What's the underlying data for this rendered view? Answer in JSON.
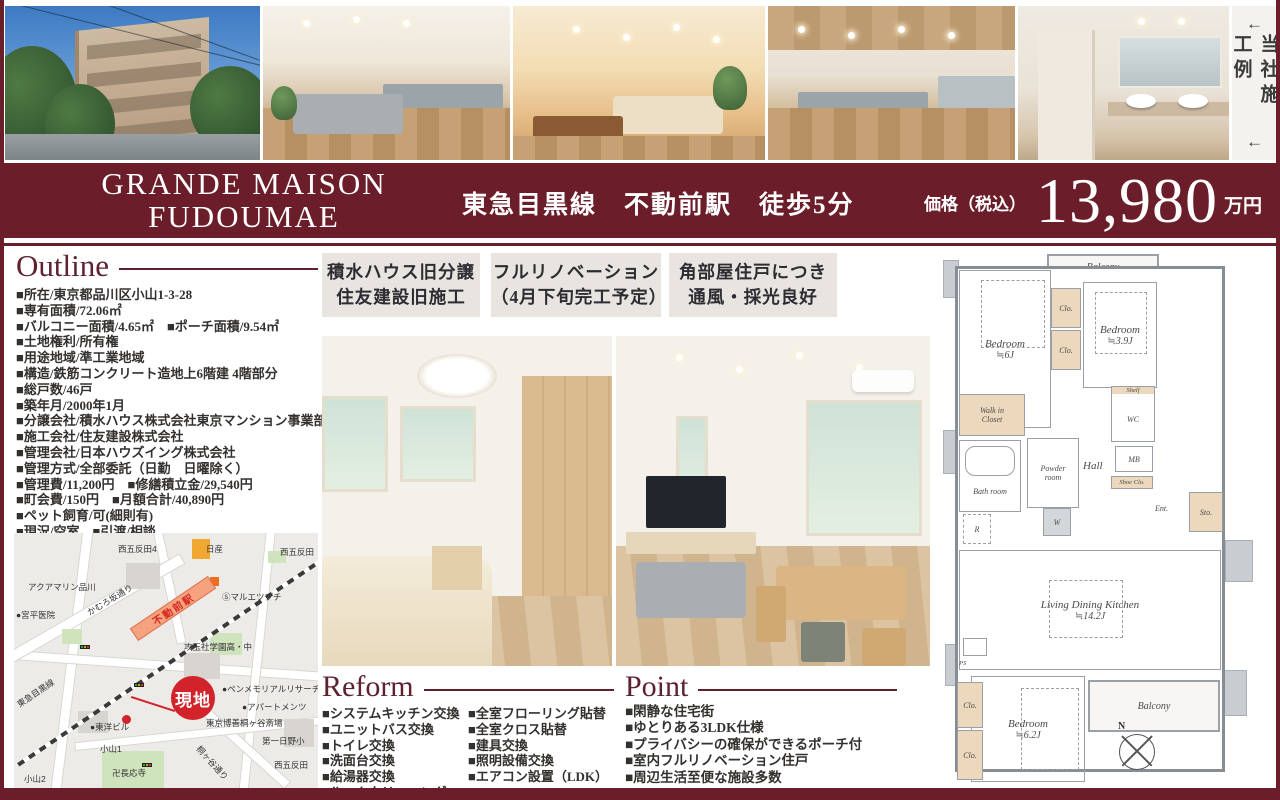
{
  "banner": {
    "arrow_top": "←",
    "text": "当社施工例",
    "arrow_bottom": "←"
  },
  "title_band": {
    "name_line1": "GRANDE MAISON",
    "name_line2": "FUDOUMAE",
    "access": "東急目黒線　不動前駅　徒歩5分",
    "price_label": "価格（税込）",
    "price_value": "13,980",
    "price_unit": "万円",
    "band_color": "#6b1e2a"
  },
  "outline": {
    "title": "Outline",
    "items": [
      "■所在/東京都品川区小山1-3-28",
      "■専有面積/72.06㎡",
      "■バルコニー面積/4.65㎡　■ポーチ面積/9.54㎡",
      "■土地権利/所有権",
      "■用途地域/準工業地域",
      "■構造/鉄筋コンクリート造地上6階建 4階部分",
      "■総戸数/46戸",
      "■築年月/2000年1月",
      "■分譲会社/積水ハウス株式会社東京マンション事業部",
      "■施工会社/住友建設株式会社",
      "■管理会社/日本ハウズイング株式会社",
      "■管理方式/全部委託（日勤　日曜除く）",
      "■管理費/11,200円　■修繕積立金/29,540円",
      "■町会費/150円　■月額合計/40,890円",
      "■ペット飼育/可(細則有)",
      "■現況/空室　■引渡/相談",
      "■備考/長期修繕計画書有"
    ]
  },
  "highlights": [
    {
      "line1": "積水ハウス旧分譲",
      "line2": "住友建設旧施工"
    },
    {
      "line1": "フルリノベーション",
      "line2": "（4月下旬完工予定）"
    },
    {
      "line1": "角部屋住戸につき",
      "line2": "通風・採光良好"
    }
  ],
  "reform": {
    "title": "Reform",
    "col1": [
      "■システムキッチン交換",
      "■ユニットバス交換",
      "■トイレ交換",
      "■洗面台交換",
      "■給湯器交換",
      "■ルームクリーニング"
    ],
    "col2": [
      "■全室フローリング貼替",
      "■全室クロス貼替",
      "■建具交換",
      "■照明設備交換",
      "■エアコン設置（LDK）"
    ]
  },
  "point": {
    "title": "Point",
    "items": [
      "■閑静な住宅街",
      "■ゆとりある3LDK仕様",
      "■プライバシーの確保ができるポーチ付",
      "■室内フルリノベーション住戸",
      "■周辺生活至便な施設多数"
    ]
  },
  "map": {
    "site_marker": "現地",
    "station": "不動前駅",
    "labels": [
      "西五反田4",
      "日産",
      "西五反田",
      "アクアマリン品川",
      "かむろ坂通り",
      "Ⓢマルエツプチ",
      "攻玉社学園高・中",
      "●ペンメモリアルリサーチ",
      "●アパートメンツ",
      "●東洋ビル",
      "小山1",
      "卍長応寺",
      "桐ヶ谷通り",
      "東京博善桐ヶ谷斎場",
      "第一日野小",
      "西五反田",
      "小山2",
      "東急目黒線",
      "●宮平医院"
    ]
  },
  "floorplan": {
    "balcony_top": "Balcony",
    "bedroom1": "Bedroom",
    "bedroom1_size": "≒6J",
    "clo1": "Clo.",
    "clo2": "Clo.",
    "bedroom2": "Bedroom",
    "bedroom2_size": "≒3.9J",
    "walkin": "Walk in Closet",
    "shelf": "Shelf",
    "wc": "WC",
    "bath": "Bath room",
    "powder": "Powder room",
    "hall": "Hall",
    "mb": "MB",
    "shoe": "Shoe Clo.",
    "ent": "Ent.",
    "sto": "Sto.",
    "r": "R",
    "w": "W",
    "ldk": "Living Dining Kitchen",
    "ldk_size": "≒14.2J",
    "balcony_right": "Balcony",
    "bedroom3": "Bedroom",
    "bedroom3_size": "≒6.2J",
    "clo3": "Clo.",
    "clo4": "Clo.",
    "ps": "PS",
    "compass_n": "N"
  }
}
